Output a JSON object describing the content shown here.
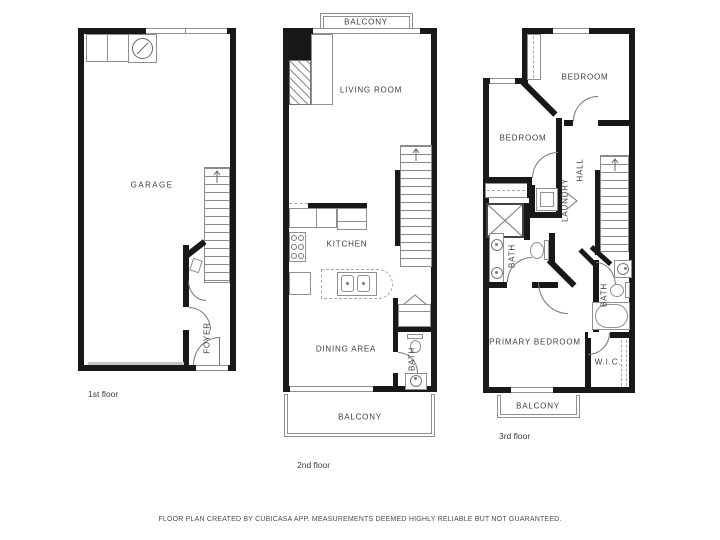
{
  "floors": {
    "first": {
      "name": "1st floor",
      "rooms": {
        "garage": "GARAGE",
        "foyer": "FOYER"
      }
    },
    "second": {
      "name": "2nd floor",
      "rooms": {
        "balcony_top": "BALCONY",
        "living_room": "LIVING ROOM",
        "kitchen": "KITCHEN",
        "dining_area": "DINING AREA",
        "bath": "BATH",
        "balcony_bottom": "BALCONY"
      }
    },
    "third": {
      "name": "3rd floor",
      "rooms": {
        "bedroom_top": "BEDROOM",
        "bedroom_left": "BEDROOM",
        "hall": "HALL",
        "laundry": "LAUNDRY",
        "bath_left": "BATH",
        "bath_right": "BATH",
        "primary_bedroom": "PRIMARY BEDROOM",
        "wic": "W.I.C.",
        "balcony": "BALCONY"
      }
    }
  },
  "footer": {
    "text": "FLOOR PLAN CREATED BY CUBICASA APP. MEASUREMENTS DEEMED HIGHLY RELIABLE BUT NOT GUARANTEED."
  },
  "colors": {
    "wall": "#181818",
    "thin_line": "#8f8f8f",
    "label_text": "#3d3d3d",
    "background": "#ffffff"
  }
}
